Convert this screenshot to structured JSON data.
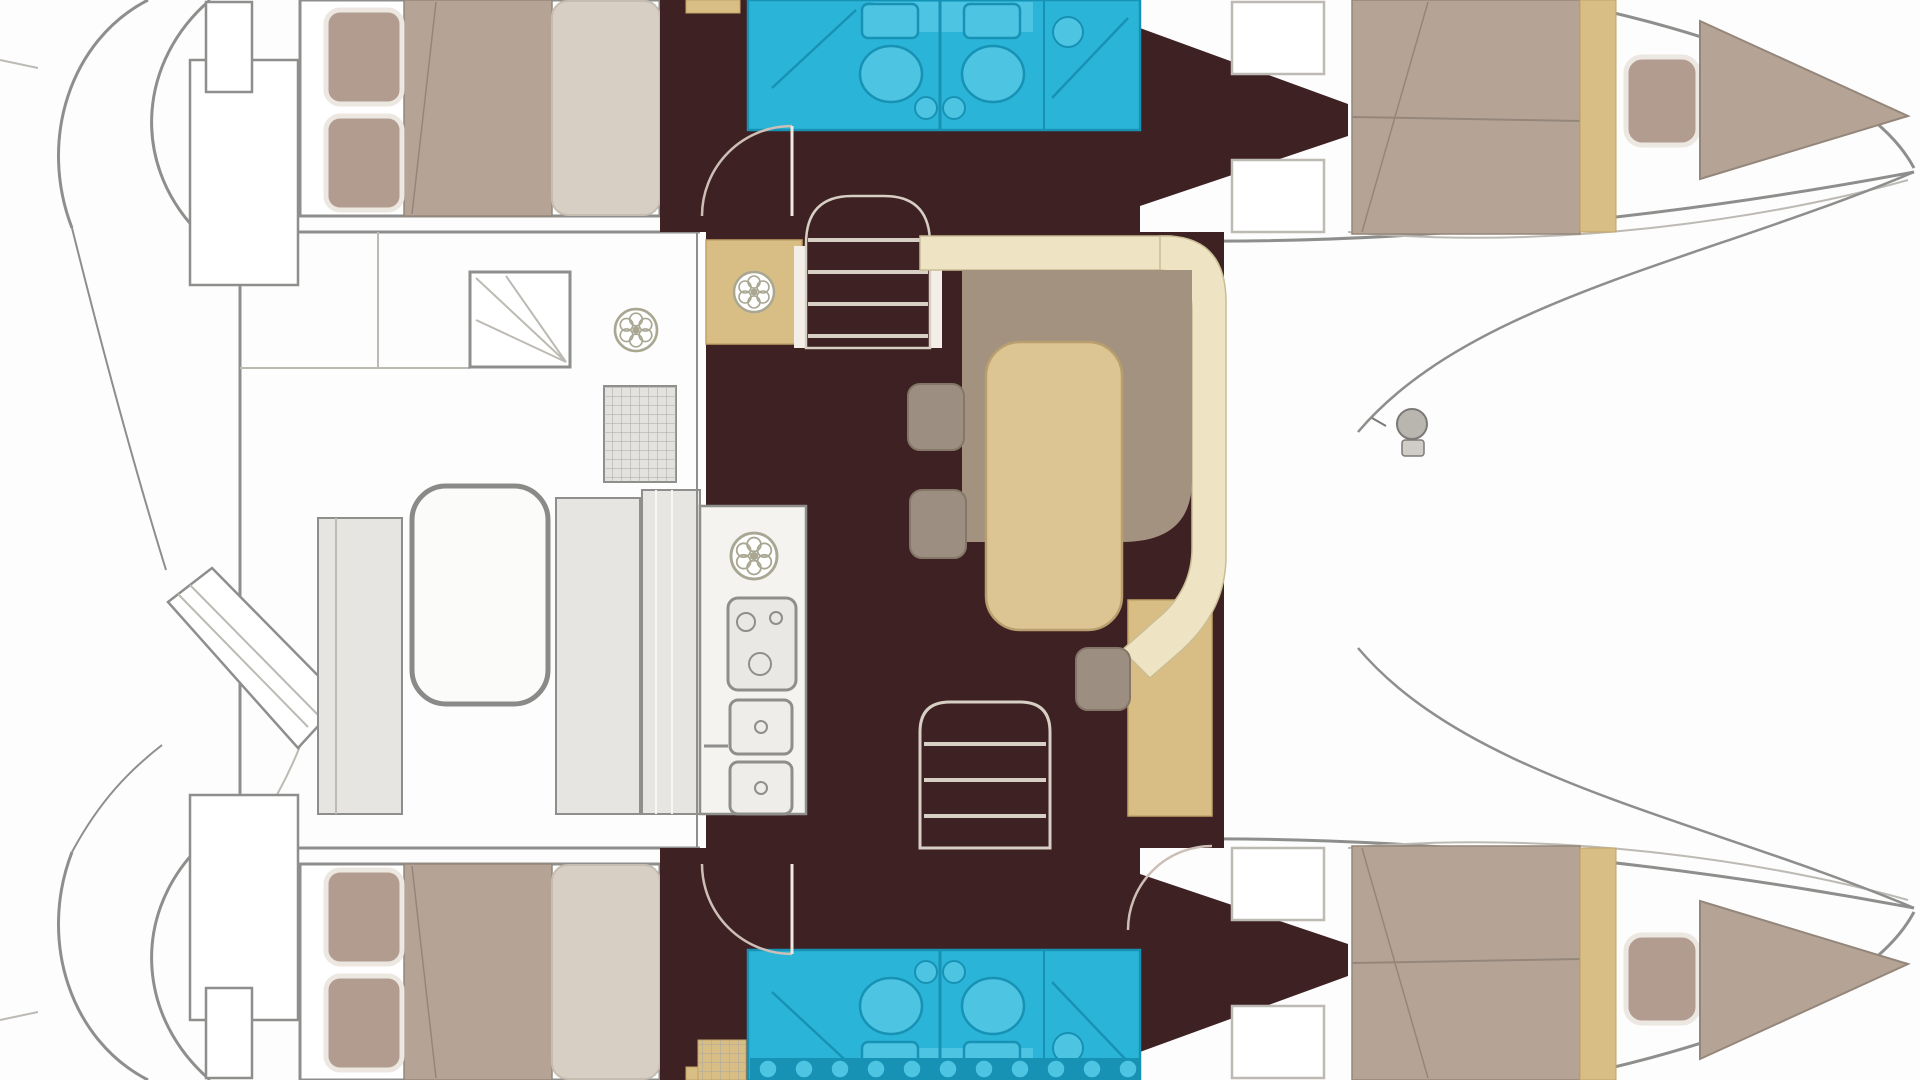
{
  "document": {
    "title": "Catamaran interior layout floor plan",
    "view": "top-down deck plan",
    "orientation": {
      "bow": "right",
      "stern": "left",
      "hulls": 2
    }
  },
  "colors": {
    "bg": "#fdfdfd",
    "line": "#8e8e8c",
    "line_light": "#bdbab4",
    "floor": "#3e2123",
    "cyan": "#2ab5d8",
    "cyan_dark": "#1792b4",
    "cyan_light": "#4cc4e2",
    "mattress": "#b5a496",
    "mattress_line": "#94867a",
    "pillow": "#b29c8f",
    "pillow_trim": "#ece7e1",
    "duvet": "#d8cfc4",
    "bench": "#eee4c4",
    "bench_line": "#c9bd93",
    "table": "#dcc493",
    "table_line": "#b99f6d",
    "sole": "#d8be85",
    "sole_line": "#c2a366",
    "backrest": "#a3927f",
    "stool": "#9c8e80",
    "stool_line": "#857767",
    "cockpit": "#e6e5e2",
    "counter": "#f4f3f0",
    "door": "#cdbfb6",
    "tread": "#d8cfc4"
  },
  "salon": {
    "position": "bridge deck center",
    "floor": "dark wood cabin sole",
    "galley": {
      "fixtures": [
        "round-sink",
        "stove-with-burners",
        "oven-drawer",
        "oven-drawer"
      ]
    },
    "dinette": {
      "table": "rounded rectangular table",
      "seating": [
        "l-shaped-cream-bench",
        "backrest-cushion",
        "stool",
        "stool",
        "stool"
      ]
    },
    "entry_step": {
      "floor": "teak step",
      "fixture": "deck-hatch"
    },
    "stairs": [
      "companionway-to-top-hull-3-treads",
      "companionway-to-bottom-hull-3-treads"
    ],
    "doors": [
      "swing-door-arc-top-hull",
      "swing-door-arc-bottom-hull"
    ]
  },
  "cockpit": {
    "position": "aft bridge deck (left)",
    "furniture": [
      "cockpit-table",
      "side-bench",
      "side-bench",
      "aft-facing-bench"
    ],
    "fixtures": [
      "grated-seat",
      "storage-locker-with-fan-lines",
      "deck-vent"
    ],
    "access": [
      "angled-transom-steps"
    ]
  },
  "port_hull": {
    "position": "top",
    "aft_cabin": {
      "berth": "double",
      "pillows": 2,
      "duvet": "cream foot section"
    },
    "head": {
      "toilets": 2,
      "basins": 2,
      "shower": "glass-door compartment"
    },
    "forward_cabin": {
      "berth": "double",
      "pillows": 1,
      "bow_berth": "v-shaped"
    },
    "deck": {
      "hatches": 2,
      "floor_wedge": "tapering cabin sole"
    }
  },
  "starboard_hull": {
    "position": "bottom",
    "aft_cabin": {
      "berth": "double",
      "pillows": 2,
      "duvet": "cream foot section"
    },
    "head": {
      "toilets": 2,
      "basins": 2,
      "shower": "glass-door compartment",
      "tiled_band": "scalloped tile strip"
    },
    "forward_cabin": {
      "berth": "double",
      "pillows": 1,
      "bow_berth": "v-shaped"
    },
    "deck": {
      "hatches": 2,
      "floor_wedge": "tapering cabin sole",
      "teak_grate": "small tan grid square"
    }
  },
  "totals": {
    "toilets": 4,
    "berths": 6,
    "pillows": 6,
    "tables": 2,
    "stools": 3,
    "deck_hatches": 4,
    "sinks": 5
  }
}
